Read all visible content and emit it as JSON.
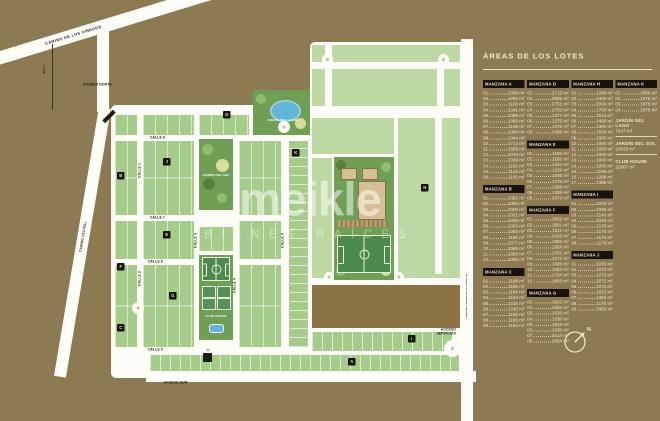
{
  "legend": {
    "title": "ÁREAS DE LOS LOTES",
    "columns": [
      {
        "blocks": [
          {
            "title": "MANZANA A",
            "areas": [
              "1039 m²",
              "1056 m²",
              "1100 m²",
              "1041 m²",
              "1099 m²",
              "1099 m²",
              "1199 m²",
              "1066 m²",
              "1094 m²",
              "1714 m²",
              "1809 m²",
              "1070 m²",
              "1009 m²",
              "1163 m²",
              "1143 m²",
              "1131 m²"
            ]
          },
          {
            "title": "MANZANA B",
            "areas": [
              "1081 m²",
              "1000 m²",
              "1000 m²",
              "1021 m²",
              "1039 m²",
              "1003 m²",
              "1093 m²",
              "1190 m²",
              "1077 m²",
              "1085 m²",
              "1092 m²",
              "1065 m²"
            ]
          },
          {
            "title": "MANZANA C",
            "areas": [
              "1108 m²",
              "1185 m²",
              "1184 m²",
              "1164 m²",
              "1234 m²",
              "1245 m²",
              "1165 m²",
              "1163 m²",
              "1164 m²"
            ]
          }
        ]
      },
      {
        "blocks": [
          {
            "title": "MANZANA D",
            "areas": [
              "2712 m²",
              "2695 m²",
              "2751 m²",
              "2793 m²",
              "1377 m²",
              "1375 m²",
              "1375 m²",
              "1405 m²"
            ]
          },
          {
            "title": "MANZANA E",
            "areas": [
              "1186 m²",
              "1202 m²",
              "1442 m²",
              "1026 m²",
              "1636 m²",
              "1476 m²",
              "1308 m²",
              "1399 m²",
              "2073 m²"
            ]
          },
          {
            "title": "MANZANA F",
            "areas": [
              "1602 m²",
              "1901 m²",
              "1011 m²",
              "2423 m²",
              "1052 m²",
              "1954 m²",
              "1701 m²",
              "1072 m²",
              "1085 m²",
              "1083 m²",
              "1794 m²",
              "1803 m²"
            ]
          },
          {
            "title": "MANZANA G",
            "areas": [
              "1602 m²",
              "1084 m²",
              "1033 m²",
              "1030 m²",
              "1043 m²",
              "1000 m²",
              "2144 m²",
              "2564 m²"
            ]
          }
        ]
      },
      {
        "blocks": [
          {
            "title": "MANZANA H",
            "areas": [
              "1299 m²",
              "2409 m²",
              "2000 m²",
              "1700 m²",
              "1514 m²",
              "1409 m²",
              "1380 m²",
              "1558 m²",
              "1000 m²",
              "1000 m²",
              "1000 m²",
              "1000 m²",
              "1000 m²",
              "1000 m²",
              "1106 m²",
              "1208 m²",
              "1399 m²"
            ]
          },
          {
            "title": "MANZANA I",
            "areas": [
              "2000 m²",
              "1000 m²",
              "1140 m²",
              "2328 m²",
              "1176 m²",
              "1175 m²",
              "1175 m²",
              "1176 m²"
            ]
          },
          {
            "title": "MANZANA J",
            "areas": [
              "1000 m²",
              "1072 m²",
              "1072 m²",
              "1072 m²",
              "1072 m²",
              "1072 m²",
              "1456 m²",
              "1176 m²",
              "3402 m²"
            ]
          }
        ]
      },
      {
        "blocks": [
          {
            "title": "MANZANA K",
            "areas": [
              "1800 m²",
              "1875 m²",
              "1875 m²",
              "1875 m²"
            ]
          }
        ],
        "specials": [
          {
            "title": "JARDÍN DEL LAGO",
            "value": "7547 m²"
          },
          {
            "title": "JARDÍN DEL SOL",
            "value": "10039 m²"
          },
          {
            "title": "CLUB HOUSE",
            "value": "22067 m²"
          }
        ]
      }
    ]
  },
  "map": {
    "roads": {
      "vinedos": "CAMINO DE LOS VIÑEDOS",
      "vecinal_left": "CAMINO VECINAL",
      "vecinal_bottom": "CAMINO VECINAL",
      "evaristo": "CAMINO EVARISTO PRIETO"
    },
    "accesses": {
      "norte": "ACCESO NORTE",
      "sur": "ACCESO SUR",
      "servicios": "ACCESO SERVICIOS"
    },
    "marker_800": "800 m",
    "parks": {
      "lago": "JARDÍN DEL LAGO",
      "sol": "JARDÍN DEL SOL",
      "club": "CLUB HOUSE"
    },
    "streets": [
      "CALLE 1",
      "CALLE 2",
      "CALLE 3",
      "CALLE 4",
      "CALLE 5",
      "CALLE 6",
      "CALLE 7",
      "CALLE 8",
      "CALLE 9"
    ],
    "chips": [
      "A",
      "B",
      "C",
      "D",
      "E",
      "F",
      "G",
      "H",
      "I",
      "J",
      "K"
    ],
    "compass_n": "N"
  },
  "watermark": {
    "brand": "meikle",
    "tagline": "BIENES RAÍCES"
  }
}
